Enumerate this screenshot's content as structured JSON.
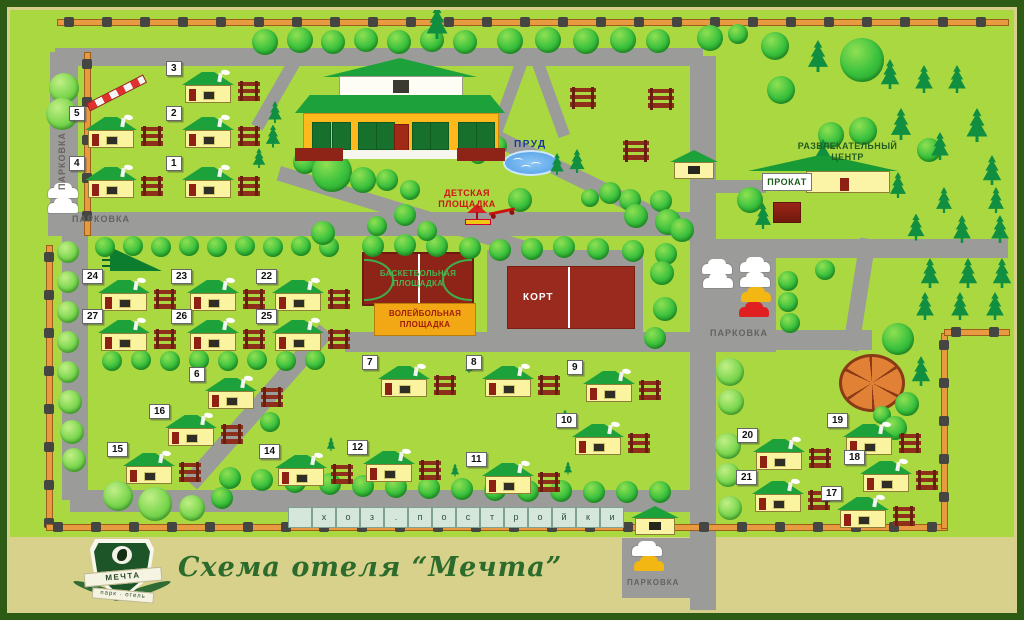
{
  "title": "Схема отеля “Мечта”",
  "logo": {
    "name": "МЕЧТА",
    "tagline": "парк · отель"
  },
  "labels": {
    "parking": "ПАРКОВКА",
    "pond": "ПРУД",
    "playground_line1": "ДЕТСКАЯ",
    "playground_line2": "ПЛОЩАДКА",
    "basketball_line1": "БАСКЕТБОЛЬНАЯ",
    "basketball_line2": "ПЛОЩАДКА",
    "volleyball_line1": "ВОЛЕЙБОЛЬНАЯ",
    "volleyball_line2": "ПЛОЩАДКА",
    "tennis": "КОРТ",
    "rental": "ПРОКАТ",
    "entertainment_line1": "РАЗВЛЕКАТЕЛЬНЫЙ",
    "entertainment_line2": "ЦЕНТР",
    "outbuildings_letters": [
      "х",
      "о",
      "з",
      ".",
      "п",
      "о",
      "с",
      "т",
      "р",
      "о",
      "й",
      "к",
      "и"
    ]
  },
  "houses": [
    {
      "n": "1",
      "x": 182,
      "y": 167
    },
    {
      "n": "2",
      "x": 182,
      "y": 117
    },
    {
      "n": "3",
      "x": 182,
      "y": 72
    },
    {
      "n": "4",
      "x": 85,
      "y": 167
    },
    {
      "n": "5",
      "x": 85,
      "y": 117
    },
    {
      "n": "6",
      "x": 205,
      "y": 378
    },
    {
      "n": "7",
      "x": 378,
      "y": 366
    },
    {
      "n": "8",
      "x": 482,
      "y": 366
    },
    {
      "n": "9",
      "x": 583,
      "y": 371
    },
    {
      "n": "10",
      "x": 572,
      "y": 424
    },
    {
      "n": "11",
      "x": 482,
      "y": 463
    },
    {
      "n": "12",
      "x": 363,
      "y": 451
    },
    {
      "n": "14",
      "x": 275,
      "y": 455
    },
    {
      "n": "15",
      "x": 123,
      "y": 453
    },
    {
      "n": "16",
      "x": 165,
      "y": 415
    },
    {
      "n": "17",
      "x": 837,
      "y": 497
    },
    {
      "n": "18",
      "x": 860,
      "y": 461
    },
    {
      "n": "19",
      "x": 843,
      "y": 424
    },
    {
      "n": "20",
      "x": 753,
      "y": 439
    },
    {
      "n": "21",
      "x": 752,
      "y": 481
    },
    {
      "n": "22",
      "x": 272,
      "y": 280
    },
    {
      "n": "23",
      "x": 187,
      "y": 280
    },
    {
      "n": "24",
      "x": 98,
      "y": 280
    },
    {
      "n": "25",
      "x": 272,
      "y": 320
    },
    {
      "n": "26",
      "x": 187,
      "y": 320
    },
    {
      "n": "27",
      "x": 98,
      "y": 320
    }
  ],
  "small_houses": [
    {
      "x": 670,
      "y": 150
    },
    {
      "x": 631,
      "y": 506
    }
  ],
  "woodpiles": [
    {
      "x": 570,
      "y": 87
    },
    {
      "x": 648,
      "y": 88
    },
    {
      "x": 623,
      "y": 140
    }
  ],
  "cars": [
    {
      "x": 48,
      "y": 188,
      "c": "white"
    },
    {
      "x": 48,
      "y": 203,
      "c": "white"
    },
    {
      "x": 702,
      "y": 264,
      "c": "white"
    },
    {
      "x": 740,
      "y": 262,
      "c": "white"
    },
    {
      "x": 703,
      "y": 278,
      "c": "white"
    },
    {
      "x": 740,
      "y": 277,
      "c": "white"
    },
    {
      "x": 741,
      "y": 292,
      "c": "yellow"
    },
    {
      "x": 739,
      "y": 307,
      "c": "red"
    },
    {
      "x": 632,
      "y": 546,
      "c": "white"
    },
    {
      "x": 634,
      "y": 561,
      "c": "yellow"
    }
  ],
  "roads": [
    {
      "x": 55,
      "y": 48,
      "w": 648,
      "h": 18
    },
    {
      "x": 50,
      "y": 52,
      "w": 28,
      "h": 170
    },
    {
      "x": 62,
      "y": 218,
      "w": 26,
      "h": 282
    },
    {
      "x": 48,
      "y": 212,
      "w": 648,
      "h": 24
    },
    {
      "x": 690,
      "y": 56,
      "w": 26,
      "h": 556
    },
    {
      "x": 345,
      "y": 332,
      "w": 350,
      "h": 20
    },
    {
      "x": 712,
      "y": 239,
      "w": 296,
      "h": 19
    },
    {
      "x": 712,
      "y": 330,
      "w": 160,
      "h": 20
    },
    {
      "x": 70,
      "y": 490,
      "w": 628,
      "h": 22
    },
    {
      "x": 622,
      "y": 538,
      "w": 70,
      "h": 60
    },
    {
      "x": 690,
      "y": 240,
      "w": 86,
      "h": 112
    },
    {
      "x": 714,
      "y": 180,
      "w": 52,
      "h": 13
    },
    {
      "x": 333,
      "y": 336,
      "w": 205,
      "h": 18,
      "rot": 131.5
    },
    {
      "x": 498,
      "y": 130,
      "w": 225,
      "h": 16,
      "rot": 26
    },
    {
      "x": 281,
      "y": 166,
      "w": 263,
      "h": 15,
      "rot": 17
    },
    {
      "x": 302,
      "y": 62,
      "w": 79,
      "h": 13,
      "rot": 120
    },
    {
      "x": 530,
      "y": 57,
      "w": 82,
      "h": 12,
      "rot": 110
    },
    {
      "x": 542,
      "y": 57,
      "w": 82,
      "h": 12,
      "rot": 70
    },
    {
      "x": 876,
      "y": 240,
      "w": 113,
      "h": 16,
      "rot": 99
    }
  ],
  "fences": [
    {
      "x": 57,
      "y": 19,
      "len": 950,
      "dir": "h"
    },
    {
      "x": 84,
      "y": 52,
      "len": 182,
      "dir": "v"
    },
    {
      "x": 46,
      "y": 245,
      "len": 282,
      "dir": "v"
    },
    {
      "x": 46,
      "y": 524,
      "len": 900,
      "dir": "h"
    },
    {
      "x": 941,
      "y": 333,
      "len": 194,
      "dir": "v"
    },
    {
      "x": 944,
      "y": 329,
      "len": 64,
      "dir": "h"
    }
  ],
  "trees": [
    [
      265,
      42,
      13
    ],
    [
      300,
      40,
      13
    ],
    [
      333,
      42,
      12
    ],
    [
      366,
      40,
      12
    ],
    [
      399,
      42,
      12
    ],
    [
      432,
      40,
      12
    ],
    [
      465,
      42,
      12
    ],
    [
      510,
      41,
      13
    ],
    [
      548,
      40,
      13
    ],
    [
      586,
      41,
      13
    ],
    [
      623,
      40,
      13
    ],
    [
      658,
      41,
      12
    ],
    [
      710,
      38,
      13
    ],
    [
      738,
      34,
      10
    ],
    [
      775,
      46,
      14
    ],
    [
      862,
      60,
      22
    ],
    [
      64,
      88,
      15,
      1
    ],
    [
      62,
      114,
      16,
      1
    ],
    [
      781,
      90,
      14
    ],
    [
      831,
      135,
      13
    ],
    [
      863,
      131,
      14
    ],
    [
      929,
      150,
      12
    ],
    [
      630,
      200,
      11
    ],
    [
      661,
      201,
      11
    ],
    [
      105,
      247,
      10
    ],
    [
      133,
      246,
      10
    ],
    [
      161,
      247,
      10
    ],
    [
      189,
      246,
      10
    ],
    [
      217,
      247,
      10
    ],
    [
      245,
      246,
      10
    ],
    [
      273,
      247,
      10
    ],
    [
      301,
      246,
      10
    ],
    [
      329,
      247,
      10
    ],
    [
      373,
      246,
      11
    ],
    [
      405,
      245,
      11
    ],
    [
      437,
      246,
      11
    ],
    [
      470,
      248,
      11
    ],
    [
      500,
      250,
      11
    ],
    [
      532,
      249,
      11
    ],
    [
      564,
      247,
      11
    ],
    [
      598,
      249,
      11
    ],
    [
      633,
      251,
      11
    ],
    [
      666,
      254,
      11
    ],
    [
      112,
      361,
      10
    ],
    [
      141,
      360,
      10
    ],
    [
      170,
      361,
      10
    ],
    [
      199,
      360,
      10
    ],
    [
      228,
      361,
      10
    ],
    [
      257,
      360,
      10
    ],
    [
      286,
      361,
      10
    ],
    [
      315,
      360,
      10
    ],
    [
      305,
      162,
      12
    ],
    [
      332,
      172,
      20
    ],
    [
      363,
      180,
      13
    ],
    [
      387,
      180,
      11
    ],
    [
      410,
      190,
      10
    ],
    [
      497,
      146,
      10
    ],
    [
      478,
      155,
      9
    ],
    [
      520,
      200,
      12
    ],
    [
      610,
      193,
      11
    ],
    [
      590,
      198,
      9
    ],
    [
      636,
      216,
      12
    ],
    [
      668,
      222,
      13
    ],
    [
      682,
      230,
      12
    ],
    [
      750,
      200,
      13
    ],
    [
      323,
      233,
      12
    ],
    [
      377,
      226,
      10
    ],
    [
      405,
      215,
      11
    ],
    [
      427,
      231,
      10
    ],
    [
      662,
      273,
      12
    ],
    [
      665,
      309,
      12
    ],
    [
      655,
      338,
      11
    ],
    [
      788,
      281,
      10
    ],
    [
      788,
      302,
      10
    ],
    [
      790,
      323,
      10
    ],
    [
      825,
      270,
      10
    ],
    [
      898,
      339,
      16
    ],
    [
      907,
      404,
      12
    ],
    [
      882,
      415,
      9
    ],
    [
      895,
      428,
      12
    ],
    [
      68,
      252,
      11,
      1
    ],
    [
      68,
      282,
      11,
      1
    ],
    [
      68,
      312,
      11,
      1
    ],
    [
      68,
      342,
      11,
      1
    ],
    [
      68,
      372,
      11,
      1
    ],
    [
      70,
      402,
      12,
      1
    ],
    [
      72,
      432,
      12,
      1
    ],
    [
      74,
      460,
      12,
      1
    ],
    [
      118,
      496,
      15,
      1
    ],
    [
      155,
      504,
      17,
      1
    ],
    [
      192,
      508,
      13,
      1
    ],
    [
      222,
      498,
      11
    ],
    [
      230,
      478,
      11
    ],
    [
      262,
      480,
      11
    ],
    [
      295,
      482,
      11
    ],
    [
      330,
      484,
      11
    ],
    [
      363,
      486,
      11
    ],
    [
      396,
      487,
      11
    ],
    [
      429,
      488,
      11
    ],
    [
      462,
      489,
      11
    ],
    [
      495,
      490,
      11
    ],
    [
      528,
      491,
      11
    ],
    [
      561,
      491,
      11
    ],
    [
      594,
      492,
      11
    ],
    [
      627,
      492,
      11
    ],
    [
      660,
      492,
      11
    ],
    [
      730,
      372,
      14,
      1
    ],
    [
      731,
      402,
      13,
      1
    ],
    [
      728,
      446,
      13,
      1
    ],
    [
      728,
      475,
      12,
      1
    ],
    [
      730,
      508,
      12,
      1
    ],
    [
      270,
      422,
      10
    ]
  ],
  "pines": [
    [
      437,
      22,
      34
    ],
    [
      275,
      112,
      22
    ],
    [
      273,
      136,
      23
    ],
    [
      259,
      158,
      20
    ],
    [
      818,
      56,
      32
    ],
    [
      890,
      74,
      30
    ],
    [
      924,
      79,
      28
    ],
    [
      957,
      79,
      28
    ],
    [
      901,
      124,
      32
    ],
    [
      940,
      146,
      28
    ],
    [
      977,
      125,
      34
    ],
    [
      823,
      157,
      36
    ],
    [
      898,
      185,
      26
    ],
    [
      992,
      170,
      30
    ],
    [
      944,
      200,
      26
    ],
    [
      996,
      200,
      26
    ],
    [
      916,
      227,
      27
    ],
    [
      962,
      229,
      28
    ],
    [
      1000,
      229,
      28
    ],
    [
      930,
      273,
      30
    ],
    [
      968,
      273,
      30
    ],
    [
      1002,
      273,
      30
    ],
    [
      925,
      306,
      28
    ],
    [
      960,
      306,
      28
    ],
    [
      995,
      306,
      28
    ],
    [
      921,
      371,
      30
    ],
    [
      557,
      164,
      22
    ],
    [
      577,
      161,
      24
    ],
    [
      763,
      216,
      26
    ],
    [
      240,
      401,
      13
    ],
    [
      331,
      444,
      14
    ],
    [
      455,
      470,
      13
    ],
    [
      568,
      468,
      13
    ],
    [
      469,
      367,
      12
    ],
    [
      565,
      416,
      13
    ]
  ],
  "colors": {
    "map_bg": "#a9d840",
    "frame": "#2d5a15",
    "strip": "#d8d18b",
    "road": "#9b9b99",
    "fence": "#e89a40",
    "house_roof": "#1da13a",
    "house_body": "#faf3a0",
    "court_red": "#8e2418",
    "volleyball": "#f2a714",
    "pond": "#4e9ee6",
    "gazebo": "#e08136",
    "car_yellow": "#f2b713",
    "car_red": "#e02020"
  }
}
